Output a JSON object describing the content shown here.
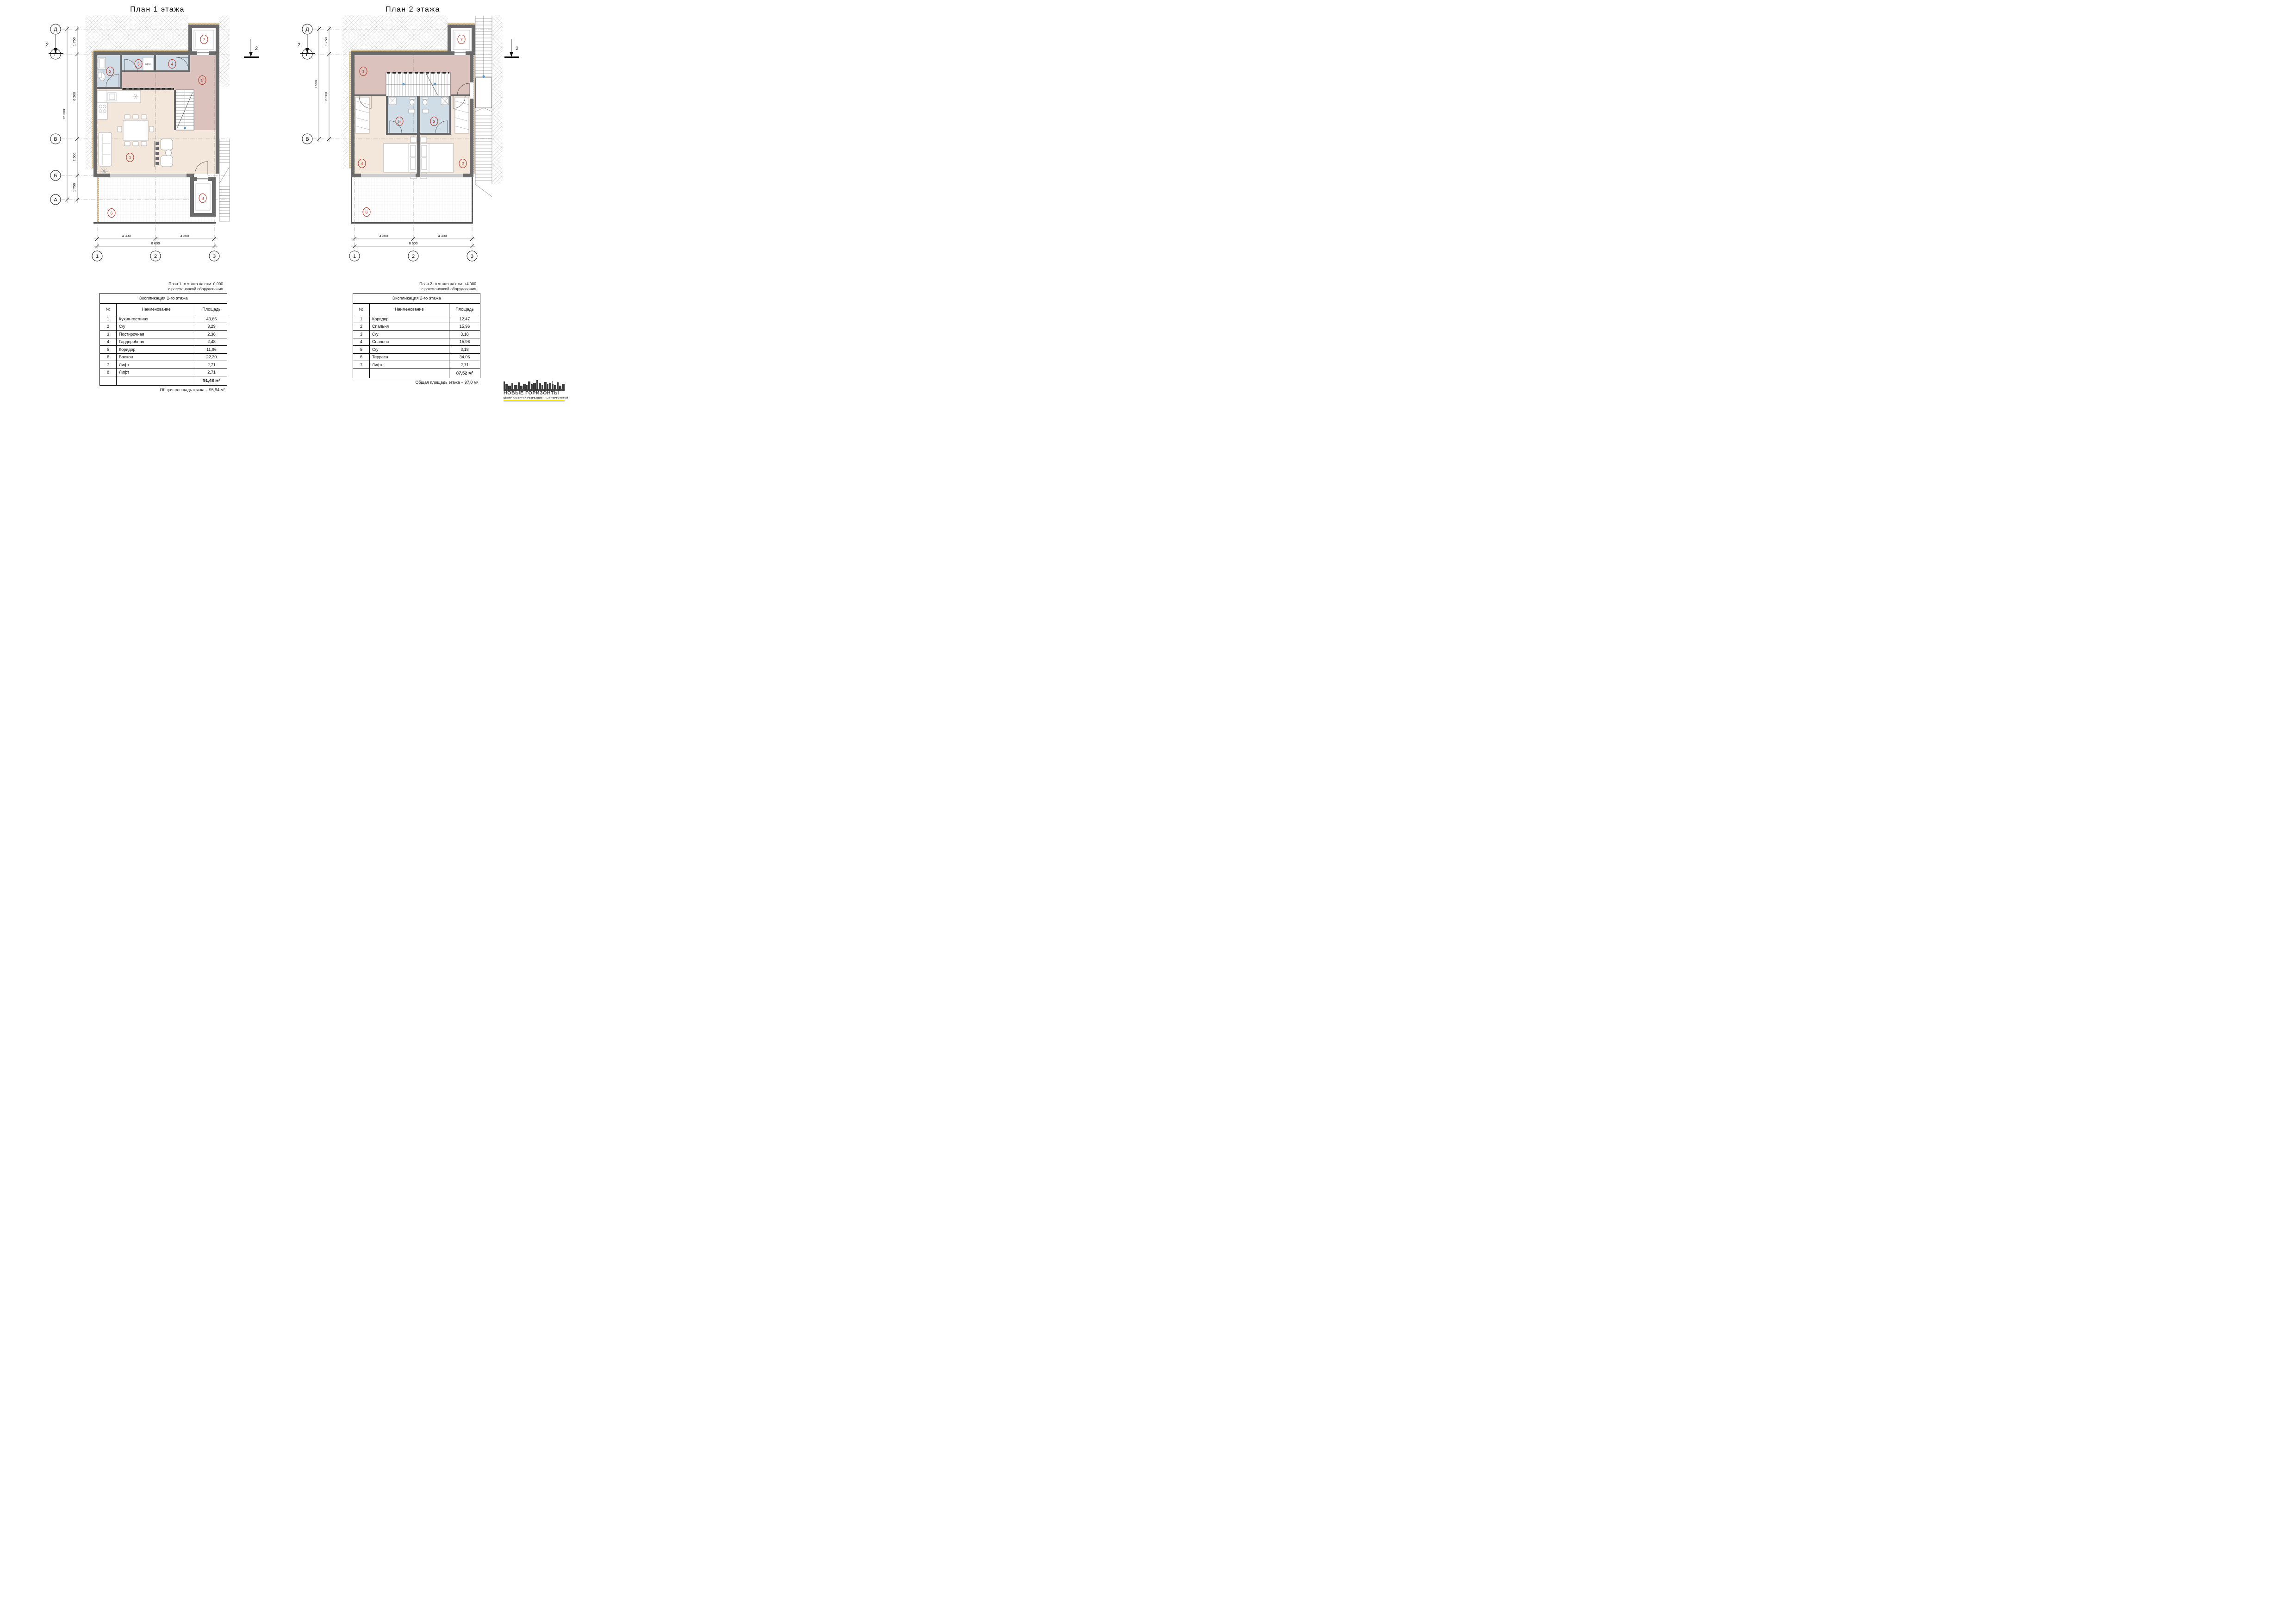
{
  "plan1": {
    "title": "План 1 этажа",
    "row_axes": [
      "Д",
      "Г",
      "В",
      "Б",
      "А"
    ],
    "col_axes": [
      "1",
      "2",
      "3"
    ],
    "dims_left": [
      "1 750",
      "6 200",
      "2 600",
      "1 750"
    ],
    "dims_left_total": "12 300",
    "dims_bottom": [
      "4 300",
      "4 300"
    ],
    "dims_bottom_total": "8 600",
    "rooms": [
      "1",
      "2",
      "3",
      "4",
      "5",
      "6",
      "7",
      "8"
    ],
    "section_label": "2",
    "equipment_label": "Ст.М."
  },
  "plan2": {
    "title": "План 2 этажа",
    "row_axes": [
      "Д",
      "Г",
      "В"
    ],
    "col_axes": [
      "1",
      "2",
      "3"
    ],
    "dims_left": [
      "1 750",
      "6 200"
    ],
    "dims_left_total": "7 950",
    "dims_bottom": [
      "4 300",
      "4 300"
    ],
    "dims_bottom_total": "8 600",
    "rooms": [
      "1",
      "2",
      "3",
      "4",
      "5",
      "6",
      "7"
    ],
    "section_label": "2"
  },
  "table1": {
    "caption_line1": "План 1-го этажа на отм. 0,000",
    "caption_line2": "с расстановкой оборудования",
    "title": "Экспликация 1-го этажа",
    "columns": [
      "№",
      "Наименование",
      "Площадь"
    ],
    "rows": [
      [
        "1",
        "Кухня-гостиная",
        "43,65"
      ],
      [
        "2",
        "С/у",
        "3,29"
      ],
      [
        "3",
        "Постирочная",
        "2,38"
      ],
      [
        "4",
        "Гардеробная",
        "2,48"
      ],
      [
        "5",
        "Коридор",
        "11,96"
      ],
      [
        "6",
        "Балкон",
        "22,30"
      ],
      [
        "7",
        "Лифт",
        "2,71"
      ],
      [
        "8",
        "Лифт",
        "2,71"
      ]
    ],
    "total": "91,48 м²",
    "note": "Общая площадь этажа – 95,94 м²"
  },
  "table2": {
    "caption_line1": "План 2-го этажа на отм. +4,080",
    "caption_line2": "с расстановкой оборудования",
    "title": "Экспликация 2-го этажа",
    "columns": [
      "№",
      "Наименование",
      "Площадь"
    ],
    "rows": [
      [
        "1",
        "Коридор",
        "12,47"
      ],
      [
        "2",
        "Спальня",
        "15,96"
      ],
      [
        "3",
        "С/у",
        "3,18"
      ],
      [
        "4",
        "Спальня",
        "15,96"
      ],
      [
        "5",
        "С/у",
        "3,18"
      ],
      [
        "6",
        "Терраса",
        "34,06"
      ],
      [
        "7",
        "Лифт",
        "2,71"
      ]
    ],
    "total": "87,52 м²",
    "note": "Общая площадь этажа – 97,0 м²"
  },
  "logo": {
    "name": "НОВЫЕ ГОРИЗОНТЫ",
    "tagline": "ЦЕНТР РАЗВИТИЯ РЕКРЕАЦИОННЫХ ТЕРРИТОРИЙ",
    "accent": "#ffe800"
  }
}
